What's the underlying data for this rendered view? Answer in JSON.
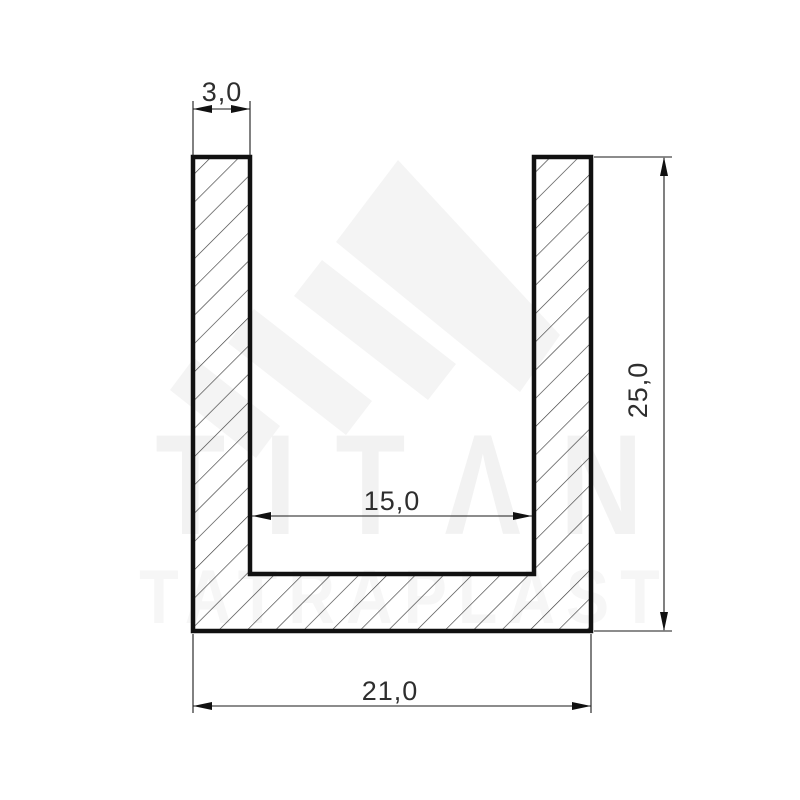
{
  "drawing": {
    "kind": "technical cross-section drawing",
    "profile_shape": "U-channel",
    "dimensions": {
      "wall_thickness": {
        "label": "3,0",
        "value": 3.0
      },
      "height": {
        "label": "25,0",
        "value": 25.0
      },
      "inner_width": {
        "label": "15,0",
        "value": 15.0
      },
      "outer_width": {
        "label": "21,0",
        "value": 21.0
      }
    },
    "watermark": {
      "brand": "TITΛN",
      "subtitle": "TATRAPLAST"
    },
    "colors": {
      "outline": "#111111",
      "hatch_line": "#3c3c3c",
      "dimension_line": "#1a1a1a",
      "dimension_text": "#2e2e2e",
      "watermark_brand": "#f2f2f2",
      "watermark_subtitle": "#f6f6f6",
      "watermark_logo": "#f4f4f4",
      "background": "#ffffff"
    }
  }
}
